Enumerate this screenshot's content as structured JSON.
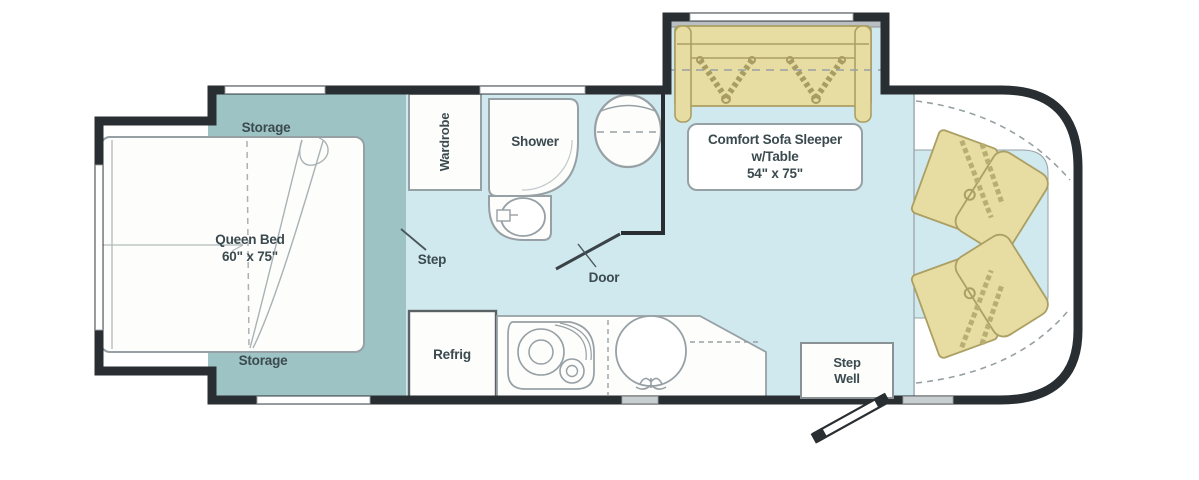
{
  "plan": {
    "type": "rv-floorplan",
    "colors": {
      "wall": "#282e31",
      "floor_blue": "#cfe9ee",
      "platform_teal": "#9dc3c4",
      "upholstery_tan": "#e7dda2",
      "upholstery_edge": "#ab9f63",
      "fixture_outline": "#97a0a4",
      "label_text": "#3b4a4f"
    },
    "labels": {
      "storage_top": "Storage",
      "storage_bottom": "Storage",
      "queen_bed": {
        "name": "Queen Bed",
        "size": "60\" x 75\""
      },
      "wardrobe": "Wardrobe",
      "shower": "Shower",
      "step": "Step",
      "door": "Door",
      "refrig": "Refrig",
      "sofa": {
        "line1": "Comfort Sofa Sleeper",
        "line2": "w/Table",
        "line3": "54\" x 75\""
      },
      "step_well": {
        "line1": "Step",
        "line2": "Well"
      }
    }
  }
}
